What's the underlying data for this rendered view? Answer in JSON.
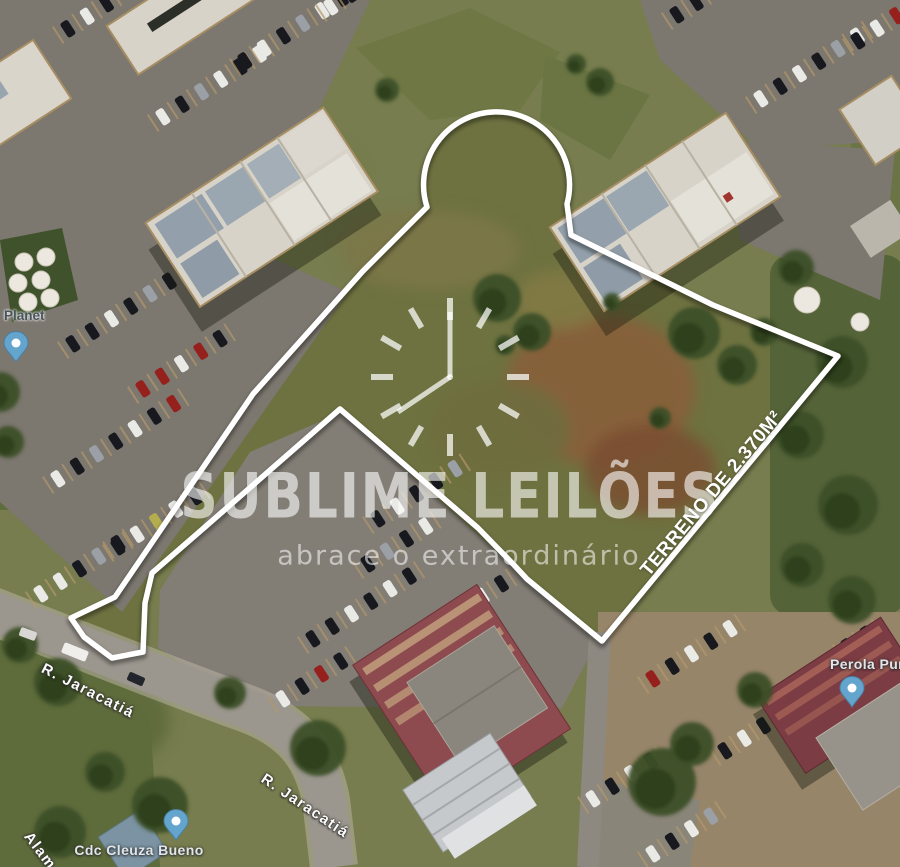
{
  "watermark": {
    "brand": "SUBLIME LEILÕES",
    "tagline": "abrace o extraordinário"
  },
  "property": {
    "area_label": "TERRENO DE 2.370M²",
    "boundary_color": "#ffffff"
  },
  "map_labels": {
    "street_a": "R. Jaracatiá",
    "street_b": "R. Jaracatiá",
    "street_c_partial": "Alam",
    "poi_planet": "Planet",
    "poi_cdc": "Cdc Cleuza Bueno",
    "poi_perola_partial": "Perola Pur"
  },
  "pins": {
    "fill": "#64a5ce"
  }
}
